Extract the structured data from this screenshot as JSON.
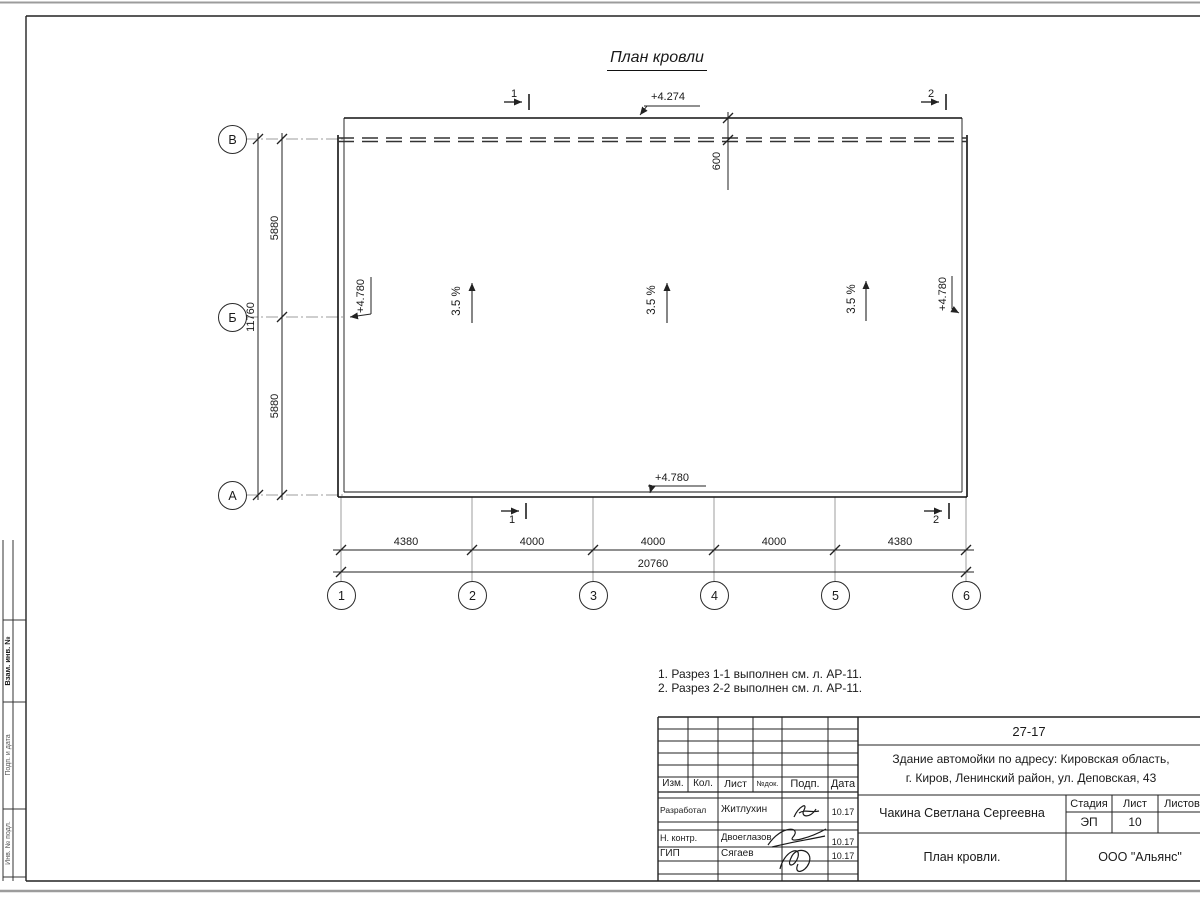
{
  "sheet": {
    "title": "План кровли",
    "notes": [
      "1. Разрез 1-1 выполнен см. л. АР-11.",
      "2. Разрез 2-2 выполнен см. л. АР-11."
    ]
  },
  "plan": {
    "elevations": {
      "top": "+4.274",
      "left": "+4.780",
      "right": "+4.780",
      "bottom": "+4.780"
    },
    "slopes": [
      "3.5 %",
      "3.5 %",
      "3.5 %"
    ],
    "dims": {
      "parapet_offset": "600",
      "left_spans": [
        "5880",
        "5880"
      ],
      "left_total": "11760",
      "bottom_spans": [
        "4380",
        "4000",
        "4000",
        "4000",
        "4380"
      ],
      "bottom_total": "20760"
    },
    "row_axes": [
      "В",
      "Б",
      "А"
    ],
    "col_axes": [
      "1",
      "2",
      "3",
      "4",
      "5",
      "6"
    ],
    "section_marks": {
      "top_1": "1",
      "top_2": "2",
      "bottom_1": "1",
      "bottom_2": "2"
    }
  },
  "titleblock": {
    "doc_number": "27-17",
    "project_line1": "Здание автомойки по адресу: Кировская область,",
    "project_line2": "г. Киров, Ленинский район, ул. Деповская, 43",
    "columns": {
      "izm": "Изм.",
      "kol": "Кол.",
      "list": "Лист",
      "ndok": "№док.",
      "podp": "Подп.",
      "data": "Дата"
    },
    "rows": [
      {
        "role": "Разработал",
        "name": "Житлухин",
        "date": "10.17"
      },
      {
        "role": "Н. контр.",
        "name": "Двоеглазов",
        "date": "10.17"
      },
      {
        "role": "ГИП",
        "name": "Сягаев",
        "date": "10.17"
      }
    ],
    "author": "Чакина Светлана Сергеевна",
    "sheet_name": "План кровли.",
    "stage_label": "Стадия",
    "sheet_label": "Лист",
    "sheets_label": "Листов",
    "stage_value": "ЭП",
    "sheet_value": "10",
    "company": "ООО \"Альянс\""
  },
  "side_stamp": {
    "labels": [
      "Взам. инв. №",
      "Подп. и дата",
      "Инв. № подл."
    ]
  }
}
